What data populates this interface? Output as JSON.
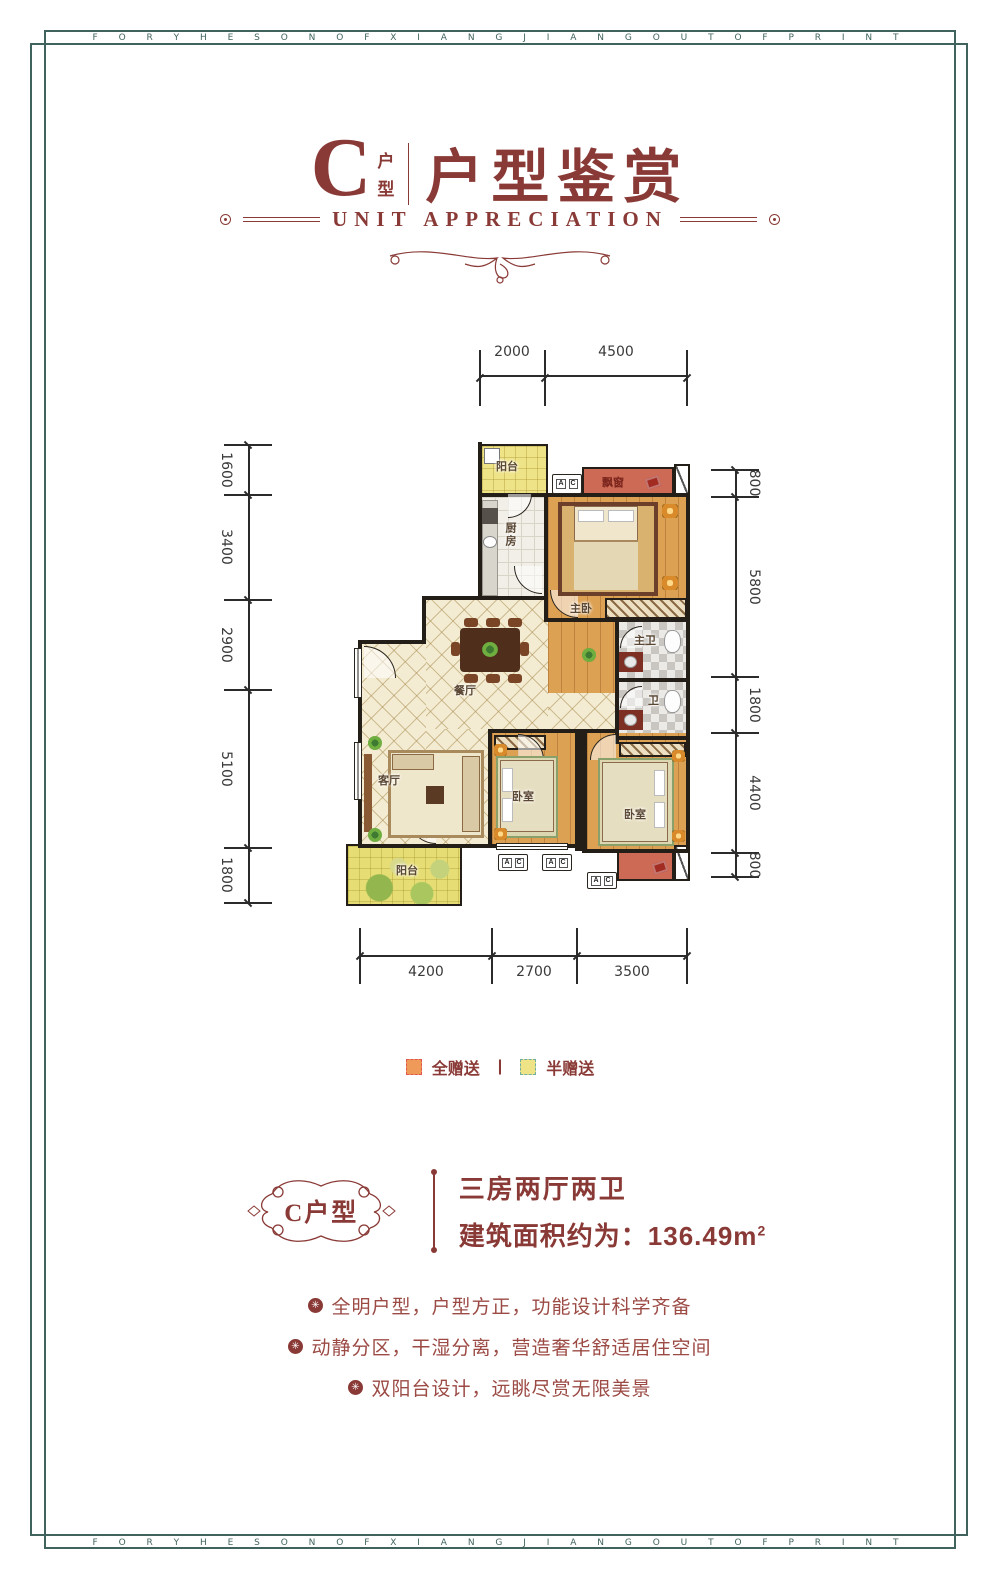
{
  "frame": {
    "band_text": "F O R Y H E S O N O F X I A N G J I A N G O U T O F P R I N T"
  },
  "header": {
    "letter": "C",
    "stack_top": "户",
    "stack_bottom": "型",
    "title": "户型鉴赏",
    "subtitle": "UNIT APPRECIATION"
  },
  "plan": {
    "rooms": {
      "balcony_top": "阳台",
      "kitchen": "厨房",
      "bay_window": "飘窗",
      "master_bedroom": "主卧",
      "master_bath": "主卫",
      "bath": "卫",
      "dining": "餐厅",
      "living": "客厅",
      "bedroom_mid": "卧室",
      "bedroom_right": "卧室",
      "balcony_bottom": "阳台"
    },
    "ac": {
      "a": "A",
      "c": "C"
    },
    "dims": {
      "top": [
        "2000",
        "4500"
      ],
      "bottom": [
        "4200",
        "2700",
        "3500"
      ],
      "left": [
        "1600",
        "3400",
        "2900",
        "5100",
        "1800"
      ],
      "right": [
        "800",
        "5800",
        "1800",
        "4400",
        "800"
      ]
    }
  },
  "legend": {
    "full_gift": "全赠送",
    "separator": "|",
    "half_gift": "半赠送"
  },
  "summary": {
    "badge": "C户型",
    "line1": "三房两厅两卫",
    "area_prefix": "建筑面积约为：",
    "area_value": "136.49m",
    "area_sup": "2"
  },
  "features": [
    "全明户型，户型方正，功能设计科学齐备",
    "动静分区，干湿分离，营造奢华舒适居住空间",
    "双阳台设计，远眺尽赏无限美景"
  ],
  "colors": {
    "maroon": "#8a3a36",
    "frame": "#41635e",
    "wall": "#241e18",
    "full_gift_fill": "#f09a5a",
    "full_gift_border": "#e2574c",
    "half_gift_fill": "#eee387",
    "half_gift_border": "#6fae9e"
  }
}
